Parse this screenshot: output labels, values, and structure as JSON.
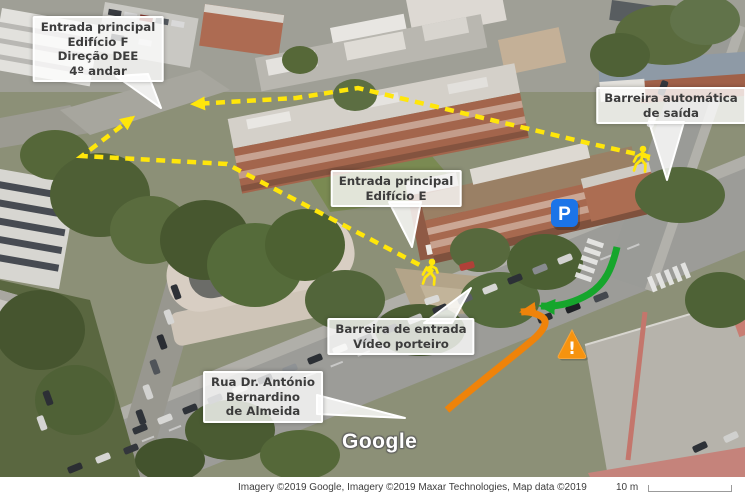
{
  "map": {
    "watermark": "Google",
    "callouts": {
      "edificio_f": {
        "line1": "Entrada principal",
        "line2": "Edifício F",
        "line3": "Direção DEE",
        "line4": "4º andar"
      },
      "barreira_saida": {
        "line1": "Barreira automática",
        "line2": "de saída"
      },
      "edificio_e": {
        "line1": "Entrada principal",
        "line2": "Edifício E"
      },
      "barreira_entrada": {
        "line1": "Barreira de entrada",
        "line2": "Vídeo porteiro"
      },
      "rua": {
        "line1": "Rua Dr. António",
        "line2": "Bernardino",
        "line3": "de Almeida"
      }
    },
    "icons": {
      "parking_label": "P",
      "warning_label": "!"
    },
    "colors": {
      "route_yellow": "#ffe60a",
      "arrow_green": "#16a62c",
      "arrow_orange": "#ef830a",
      "parking_blue": "#1b74e8",
      "warning_orange": "#f6930f"
    }
  },
  "footer": {
    "attribution": "Imagery ©2019 Google, Imagery ©2019 Maxar Technologies, Map data ©2019",
    "scale_label": "10 m"
  }
}
